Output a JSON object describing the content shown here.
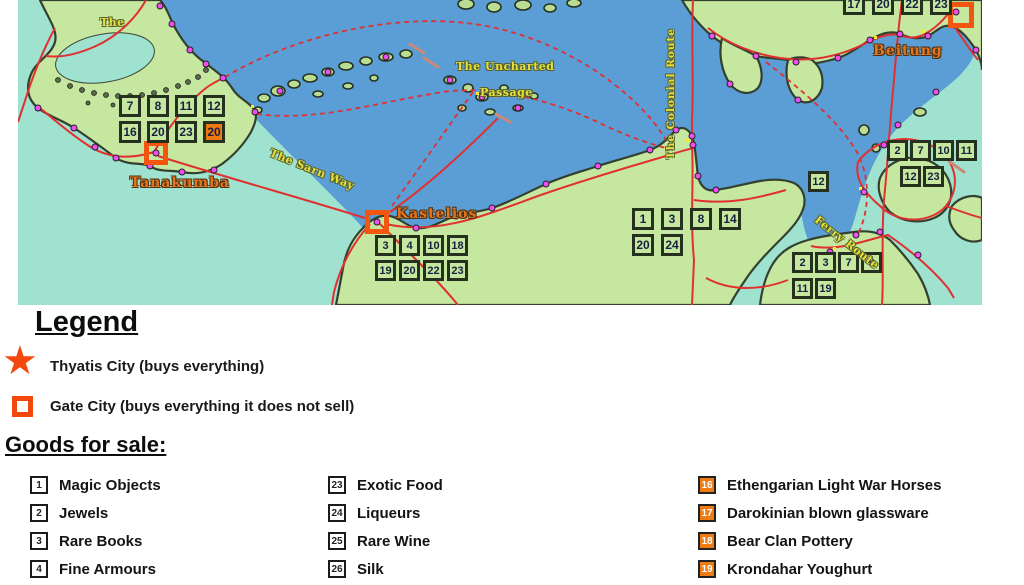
{
  "map": {
    "colors": {
      "sea": "#5b9ed6",
      "shallow": "#9fe2cf",
      "land": "#c6e79f",
      "coast": "#33402f",
      "route": "#e03030",
      "route_label": "#e6e03e",
      "city_label": "#e8731d",
      "gate": "#f3560e",
      "box_border": "#26301f",
      "box_highlight": "#f0780f"
    },
    "route_labels": [
      {
        "id": "nw-partial",
        "text": "The",
        "x": 82,
        "y": 16,
        "rotate": 0,
        "vertical": false
      },
      {
        "id": "sarn-way",
        "text": "The Sarn Way",
        "x": 252,
        "y": 146,
        "rotate": 22,
        "vertical": false
      },
      {
        "id": "uncharted-1",
        "text": "The Uncharted",
        "x": 438,
        "y": 60,
        "rotate": 0,
        "vertical": false
      },
      {
        "id": "uncharted-2",
        "text": "Passage",
        "x": 462,
        "y": 86,
        "rotate": 0,
        "vertical": false
      },
      {
        "id": "colonial",
        "text": "The Colonial Route",
        "x": 659,
        "y": 28,
        "rotate": 0,
        "vertical": true
      },
      {
        "id": "ferry",
        "text": "Ferry Route",
        "x": 798,
        "y": 212,
        "rotate": 38,
        "vertical": false
      }
    ],
    "city_labels": [
      {
        "id": "tanakumba",
        "text": "Tanakumba",
        "x": 112,
        "y": 175
      },
      {
        "id": "kastelios",
        "text": "Kastelios",
        "x": 378,
        "y": 206
      },
      {
        "id": "beitung",
        "text": "Beitung",
        "x": 855,
        "y": 43
      }
    ],
    "grids": [
      {
        "id": "tanakumba",
        "x": 101,
        "y": 95,
        "pitch_x": 28,
        "pitch_y": 26,
        "box": 22,
        "rows": [
          [
            "7",
            "8",
            "11",
            "12"
          ],
          [
            "16",
            "20",
            "23",
            "20"
          ]
        ],
        "row_offsets": [
          0,
          0
        ],
        "highlights": [
          [
            1,
            3
          ]
        ]
      },
      {
        "id": "kastelios",
        "x": 357,
        "y": 235,
        "pitch_x": 24,
        "pitch_y": 25,
        "box": 21,
        "rows": [
          [
            "3",
            "4",
            "10",
            "18"
          ],
          [
            "19",
            "20",
            "22",
            "23"
          ]
        ],
        "row_offsets": [
          0,
          0
        ],
        "highlights": []
      },
      {
        "id": "central",
        "x": 614,
        "y": 208,
        "pitch_x": 29,
        "pitch_y": 26,
        "box": 22,
        "rows": [
          [
            "1",
            "3",
            "8",
            "14"
          ],
          [
            "20",
            "24"
          ]
        ],
        "row_offsets": [
          0,
          0
        ],
        "highlights": []
      },
      {
        "id": "beitung",
        "x": 825,
        "y": -7,
        "pitch_x": 29,
        "pitch_y": 26,
        "box": 22,
        "rows": [
          [
            "17",
            "20",
            "22",
            "23"
          ]
        ],
        "row_offsets": [
          0
        ],
        "highlights": []
      },
      {
        "id": "east",
        "x": 869,
        "y": 140,
        "pitch_x": 23,
        "pitch_y": 26,
        "box": 21,
        "rows": [
          [
            "2",
            "7",
            "10",
            "11"
          ],
          [
            "12",
            "23"
          ]
        ],
        "row_offsets": [
          0,
          13
        ],
        "highlights": []
      },
      {
        "id": "strait",
        "x": 790,
        "y": 171,
        "pitch_x": 23,
        "pitch_y": 26,
        "box": 21,
        "rows": [
          [
            "12"
          ]
        ],
        "row_offsets": [
          0
        ],
        "highlights": []
      },
      {
        "id": "southeast",
        "x": 774,
        "y": 252,
        "pitch_x": 23,
        "pitch_y": 26,
        "box": 21,
        "rows": [
          [
            "2",
            "3",
            "7",
            "8"
          ],
          [
            "11",
            "19"
          ]
        ],
        "row_offsets": [
          0,
          0
        ],
        "highlights": []
      }
    ]
  },
  "legend": {
    "title": "Legend",
    "items": [
      {
        "icon": "star-icon",
        "label": "Thyatis City (buys everything)"
      },
      {
        "icon": "gate-square-icon",
        "label": "Gate City (buys everything it does not sell)"
      }
    ]
  },
  "goods": {
    "title": "Goods for sale:",
    "columns": [
      {
        "style": "plain",
        "items": [
          {
            "n": "1",
            "label": "Magic Objects"
          },
          {
            "n": "2",
            "label": "Jewels"
          },
          {
            "n": "3",
            "label": "Rare Books"
          },
          {
            "n": "4",
            "label": "Fine Armours"
          }
        ]
      },
      {
        "style": "plain",
        "items": [
          {
            "n": "23",
            "label": "Exotic Food"
          },
          {
            "n": "24",
            "label": "Liqueurs"
          },
          {
            "n": "25",
            "label": "Rare Wine"
          },
          {
            "n": "26",
            "label": "Silk"
          }
        ]
      },
      {
        "style": "orange",
        "items": [
          {
            "n": "16",
            "label": "Ethengarian Light War Horses"
          },
          {
            "n": "17",
            "label": "Darokinian blown glassware"
          },
          {
            "n": "18",
            "label": "Bear Clan Pottery"
          },
          {
            "n": "19",
            "label": "Krondahar Youghurt"
          }
        ]
      }
    ]
  }
}
